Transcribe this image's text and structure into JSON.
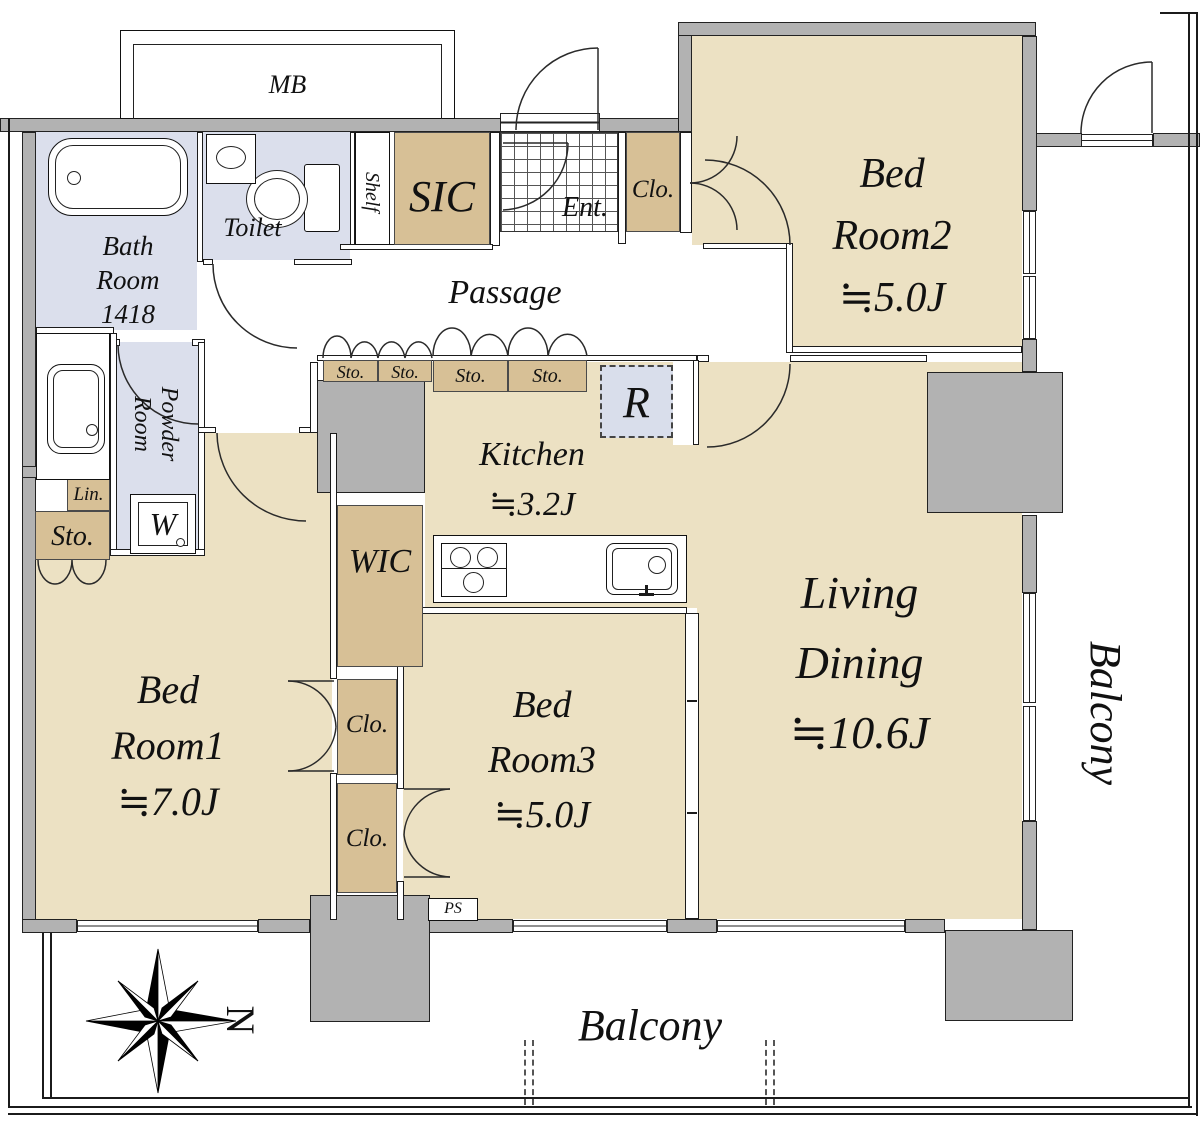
{
  "rooms": {
    "bed_room_1": {
      "line1": "Bed",
      "line2": "Room1",
      "area": "≒7.0J"
    },
    "bed_room_2": {
      "line1": "Bed",
      "line2": "Room2",
      "area": "≒5.0J"
    },
    "bed_room_3": {
      "line1": "Bed",
      "line2": "Room3",
      "area": "≒5.0J"
    },
    "living_dining": {
      "line1": "Living",
      "line2": "Dining",
      "area": "≒10.6J"
    },
    "kitchen": {
      "name": "Kitchen",
      "area": "≒3.2J"
    },
    "bath_room": {
      "line1": "Bath",
      "line2": "Room",
      "line3": "1418"
    },
    "toilet": {
      "name": "Toilet"
    },
    "powder_room": {
      "line1": "Powder",
      "line2": "Room"
    },
    "passage": {
      "name": "Passage"
    },
    "entrance": {
      "name": "Ent."
    },
    "shoe_closet": {
      "name": "SIC"
    },
    "shelf": {
      "name": "Shelf"
    },
    "walk_in_closet": {
      "name": "WIC"
    }
  },
  "closets": {
    "top": "Clo.",
    "bedroom1": "Clo.",
    "bedroom3": "Clo."
  },
  "storage": {
    "passage_1": "Sto.",
    "passage_2": "Sto.",
    "passage_3": "Sto.",
    "passage_4": "Sto.",
    "left": "Sto.",
    "linen": "Lin."
  },
  "fixtures": {
    "meter_box": "MB",
    "pipe_shaft": "PS",
    "refrigerator_space": "R",
    "washing_machine": "W"
  },
  "balcony": {
    "bottom": "Balcony",
    "right": "Balcony"
  },
  "compass": {
    "north": "N"
  },
  "colors": {
    "room": "#ece1c3",
    "closet": "#d7c096",
    "wet_area": "#dbdfec",
    "refrigerator": "#d9deeb",
    "wall": "#b2b2b2",
    "line": "#1b1b1b"
  }
}
